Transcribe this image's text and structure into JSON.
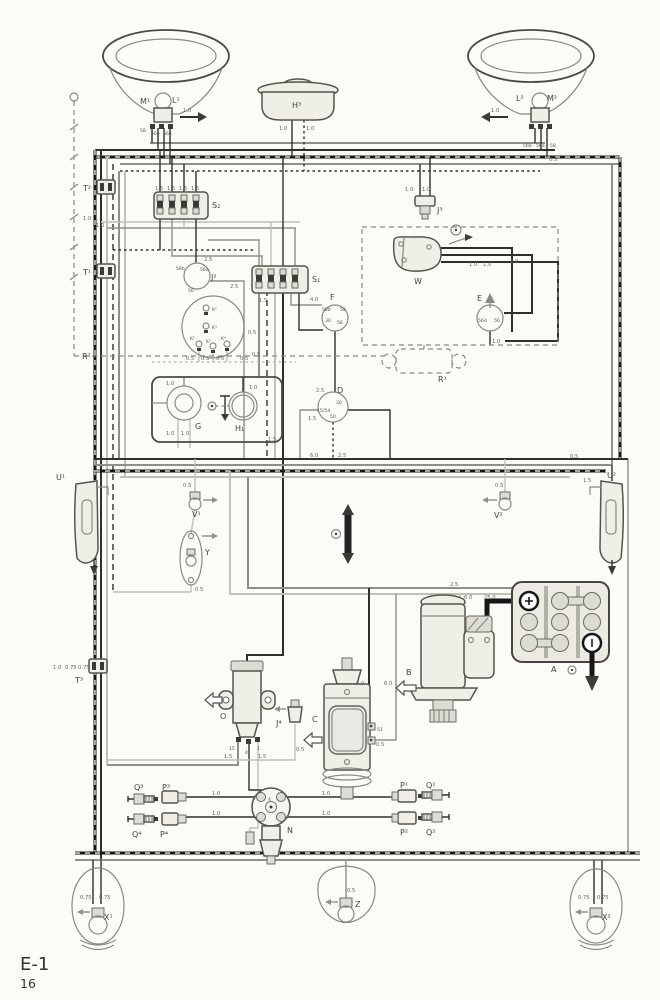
{
  "page": {
    "code": "E-1",
    "number": "16"
  },
  "gauges": {
    "g05": "0.5",
    "g075": "0.75",
    "g10": "1.0",
    "g15": "1.5",
    "g25": "2.5",
    "g40": "4.0",
    "g60": "6.0",
    "g250": "25.0"
  },
  "labels": {
    "m1": "M¹",
    "l1": "L¹",
    "l2": "L²",
    "m2": "M²",
    "h3": "H³",
    "t1": "T¹",
    "t2": "T²",
    "t3": "T³",
    "s1": "S₁",
    "s2": "S₂",
    "j2": "J²",
    "j3": "J³",
    "j4": "J⁴",
    "w": "W",
    "e": "E",
    "f": "F",
    "r1": "R¹",
    "r2": "R²",
    "g": "G",
    "h1": "H₁",
    "d": "D",
    "k1": "K¹",
    "k3a": "K³",
    "k2": "K²",
    "k3b": "K³",
    "k4": "K⁴",
    "u1": "U¹",
    "u2": "U²",
    "v1": "V¹",
    "v2": "V²",
    "y": "Y",
    "a": "A",
    "b": "B",
    "c": "C",
    "o": "O",
    "n": "N",
    "p1": "P¹",
    "p2": "P²",
    "p3": "P³",
    "p4": "P⁴",
    "q1": "Q¹",
    "q2": "Q²",
    "q3": "Q³",
    "q4": "Q⁴",
    "x1": "X¹",
    "x2": "X²",
    "z": "Z"
  },
  "terminals": {
    "t58": "58",
    "t56a": "56a",
    "t56b": "56b",
    "t56": "56",
    "t56d": "56d",
    "t58b": "58b",
    "t30": "30",
    "t50": "50",
    "t1554": "15/54",
    "t15": "15",
    "t4": "4",
    "t1": "1",
    "t51": "51",
    "n4": "4"
  }
}
